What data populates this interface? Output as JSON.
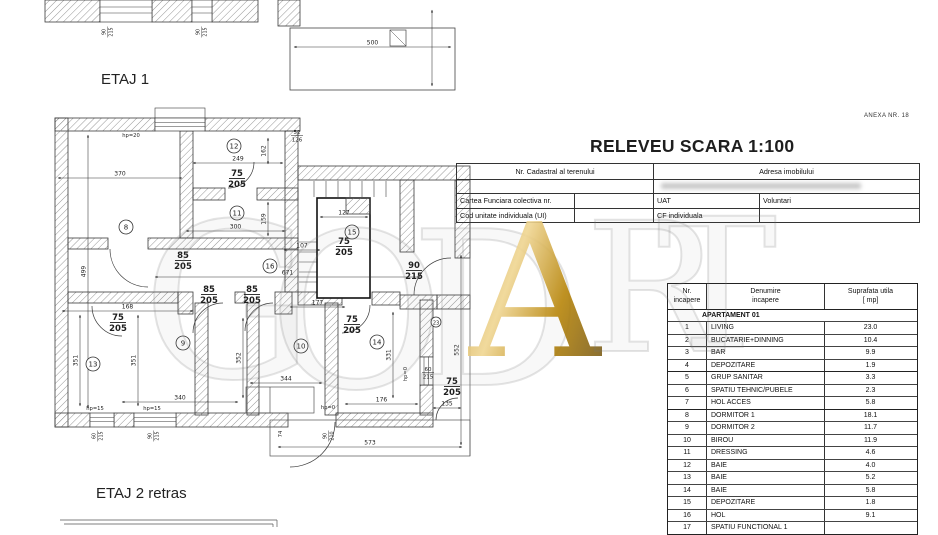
{
  "titles": {
    "releveu": "RELEVEU SCARA 1:100",
    "anexa": "ANEXA  NR. 18",
    "etaj1": "ETAJ 1",
    "etaj2": "ETAJ 2 retras"
  },
  "cadastral": {
    "nr_cadastral_label": "Nr. Cadastral al terenului",
    "adresa_label": "Adresa imobilului",
    "cartea_funciara_label": "Cartea Funciara colectiva nr.",
    "uat_label": "UAT",
    "uat_value": "Voluntari",
    "cod_unitate_label": "Cod unitate individuala (UI)",
    "cf_individuala_label": "CF individuala"
  },
  "room_table": {
    "headers": {
      "nr1": "Nr.",
      "nr2": "incapere",
      "den1": "Denumire",
      "den2": "incapere",
      "sup1": "Suprafata utila",
      "sup2": "[ mp]"
    },
    "group": "APARTAMENT 01",
    "rows": [
      [
        "1",
        "LIVING",
        "23.0"
      ],
      [
        "2",
        "BUCATARIE+DINNING",
        "10.4"
      ],
      [
        "3",
        "BAR",
        "9.9"
      ],
      [
        "4",
        "DEPOZITARE",
        "1.9"
      ],
      [
        "5",
        "GRUP SANITAR",
        "3.3"
      ],
      [
        "6",
        "SPATIU TEHNIC/PUBELE",
        "2.3"
      ],
      [
        "7",
        "HOL ACCES",
        "5.8"
      ],
      [
        "8",
        "DORMITOR 1",
        "18.1"
      ],
      [
        "9",
        "DORMITOR 2",
        "11.7"
      ],
      [
        "10",
        "BIROU",
        "11.9"
      ],
      [
        "11",
        "DRESSING",
        "4.6"
      ],
      [
        "12",
        "BAIE",
        "4.0"
      ],
      [
        "13",
        "BAIE",
        "5.2"
      ],
      [
        "14",
        "BAIE",
        "5.8"
      ],
      [
        "15",
        "DEPOZITARE",
        "1.8"
      ],
      [
        "16",
        "HOL",
        "9.1"
      ],
      [
        "17",
        "SPATIU FUNCTIONAL 1",
        ""
      ]
    ],
    "thick_before": [
      "5",
      "8"
    ]
  },
  "watermark": {
    "letters": [
      "G",
      "O",
      "D",
      "A",
      "R",
      "T"
    ]
  },
  "plan": {
    "rooms": [
      {
        "n": "8",
        "x": 126,
        "y": 227
      },
      {
        "n": "9",
        "x": 183,
        "y": 343
      },
      {
        "n": "10",
        "x": 301,
        "y": 346
      },
      {
        "n": "11",
        "x": 237,
        "y": 213
      },
      {
        "n": "12",
        "x": 234,
        "y": 146
      },
      {
        "n": "13",
        "x": 93,
        "y": 364
      },
      {
        "n": "14",
        "x": 377,
        "y": 342
      },
      {
        "n": "15",
        "x": 352,
        "y": 232
      },
      {
        "n": "16",
        "x": 270,
        "y": 266
      },
      {
        "n": "23",
        "x": 436,
        "y": 322,
        "r": 5
      }
    ],
    "hdims": [
      {
        "t": "370",
        "x1": 58,
        "x2": 182,
        "y": 178
      },
      {
        "t": "249",
        "x1": 193,
        "x2": 283,
        "y": 163
      },
      {
        "t": "300",
        "x1": 186,
        "x2": 285,
        "y": 231
      },
      {
        "t": "671",
        "x1": 155,
        "x2": 420,
        "y": 277
      },
      {
        "t": "107",
        "x1": 284,
        "x2": 320,
        "y": 250
      },
      {
        "t": "127",
        "x1": 320,
        "x2": 368,
        "y": 217
      },
      {
        "t": "168",
        "x1": 62,
        "x2": 193,
        "y": 311
      },
      {
        "t": "340",
        "x1": 122,
        "x2": 238,
        "y": 402
      },
      {
        "t": "344",
        "x1": 250,
        "x2": 322,
        "y": 383
      },
      {
        "t": "177",
        "x1": 290,
        "x2": 345,
        "y": 307
      },
      {
        "t": "176",
        "x1": 345,
        "x2": 418,
        "y": 404
      },
      {
        "t": "135",
        "x1": 433,
        "x2": 461,
        "y": 408
      },
      {
        "t": "573",
        "x1": 278,
        "x2": 462,
        "y": 447
      },
      {
        "t": "500",
        "x1": 294,
        "x2": 451,
        "y": 47
      }
    ],
    "vdims": [
      {
        "t": "499",
        "x": 88,
        "y1": 135,
        "y2": 408
      },
      {
        "t": "162",
        "x": 268,
        "y1": 138,
        "y2": 164
      },
      {
        "t": "159",
        "x": 268,
        "y1": 202,
        "y2": 236
      },
      {
        "t": "351",
        "x": 80,
        "y1": 315,
        "y2": 406
      },
      {
        "t": "351",
        "x": 138,
        "y1": 315,
        "y2": 406
      },
      {
        "t": "352",
        "x": 243,
        "y1": 318,
        "y2": 398
      },
      {
        "t": "331",
        "x": 393,
        "y1": 312,
        "y2": 398
      },
      {
        "t": "552",
        "x": 461,
        "y1": 255,
        "y2": 445
      }
    ],
    "fracs": [
      {
        "a": "75",
        "b": "205",
        "x": 237,
        "y": 168
      },
      {
        "a": "85",
        "b": "205",
        "x": 183,
        "y": 250
      },
      {
        "a": "85",
        "b": "205",
        "x": 209,
        "y": 284
      },
      {
        "a": "85",
        "b": "205",
        "x": 252,
        "y": 284
      },
      {
        "a": "75",
        "b": "205",
        "x": 344,
        "y": 236
      },
      {
        "a": "90",
        "b": "215",
        "x": 414,
        "y": 260
      },
      {
        "a": "75",
        "b": "205",
        "x": 118,
        "y": 312
      },
      {
        "a": "75",
        "b": "205",
        "x": 352,
        "y": 314
      },
      {
        "a": "75",
        "b": "205",
        "x": 452,
        "y": 376
      },
      {
        "a": "52",
        "b": "126",
        "x": 297,
        "y": 129,
        "s": 1
      },
      {
        "a": "60",
        "b": "215",
        "x": 428,
        "y": 366,
        "s": 1
      }
    ],
    "rfracs": [
      {
        "a": "90",
        "b": "215",
        "x": 107,
        "y": 32
      },
      {
        "a": "90",
        "b": "215",
        "x": 201,
        "y": 32
      },
      {
        "a": "60",
        "b": "215",
        "x": 97,
        "y": 436
      },
      {
        "a": "90",
        "b": "215",
        "x": 153,
        "y": 436
      },
      {
        "a": "90",
        "b": "210",
        "x": 328,
        "y": 436
      }
    ],
    "small": [
      {
        "t": "hp=20",
        "x": 131,
        "y": 137
      },
      {
        "t": "hp=15",
        "x": 95,
        "y": 410
      },
      {
        "t": "hp=15",
        "x": 152,
        "y": 410
      },
      {
        "t": "hp=0",
        "x": 328,
        "y": 409
      },
      {
        "t": "hp=0",
        "x": 407,
        "y": 374,
        "rot": 1
      },
      {
        "t": "74",
        "x": 282,
        "y": 434,
        "rot": 1
      }
    ]
  }
}
